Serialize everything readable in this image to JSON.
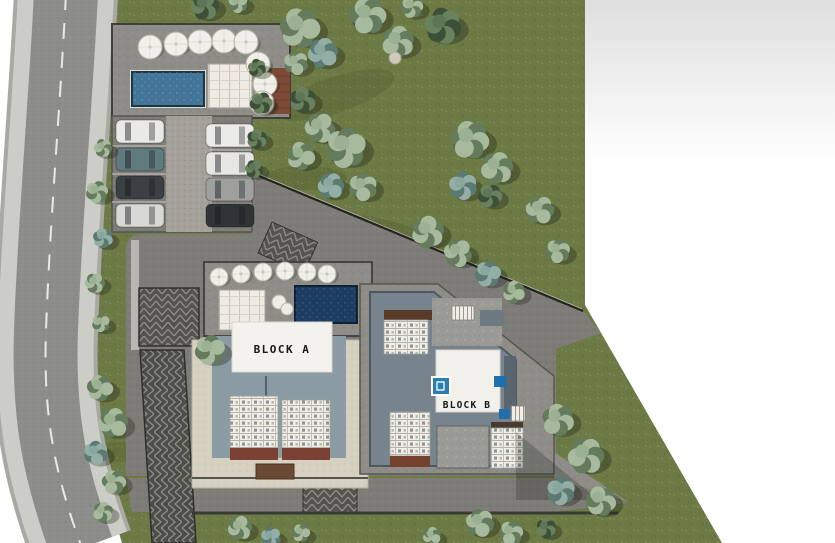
{
  "scene": {
    "type": "3d-architectural-site-plan-render",
    "labels": {
      "block_a": "BLOCK A",
      "block_b": "BLOCK B"
    },
    "palette": {
      "page": "#ffffff",
      "grass": "#6c7a45",
      "road_asphalt": "#8d8d89",
      "sidewalk": "#cdcdc8",
      "pavement": "#7e7c77",
      "walkway": "#8f8d87",
      "beige_court": "#d6d0c1",
      "terrace_pool": "#427598",
      "roof_pool": "#1d3c60",
      "roof_white": "#f4f2ec",
      "roof_bluegray": "#8b9ba4",
      "brick": "#7b4233",
      "wood_deck": "#7d4a36",
      "accent_blue": "#2b7fae",
      "fence": "#23231f"
    },
    "pool_terrace_umbrellas": [
      [
        150,
        47
      ],
      [
        176,
        44
      ],
      [
        200,
        42
      ],
      [
        224,
        41
      ],
      [
        246,
        42
      ],
      [
        258,
        64
      ],
      [
        265,
        84
      ],
      [
        262,
        103
      ]
    ],
    "block_a_deck_umbrellas": [
      [
        219,
        277
      ],
      [
        241,
        274
      ],
      [
        263,
        272
      ],
      [
        285,
        271
      ],
      [
        307,
        272
      ],
      [
        327,
        274
      ]
    ],
    "parking_cars_left": [
      {
        "x": 116,
        "y": 120,
        "color": "#e9e9e7"
      },
      {
        "x": 116,
        "y": 148,
        "color": "#5f7b7e"
      },
      {
        "x": 116,
        "y": 176,
        "color": "#3a4043"
      },
      {
        "x": 116,
        "y": 204,
        "color": "#d8d8d5"
      }
    ],
    "parking_cars_right": [
      {
        "x": 206,
        "y": 124,
        "color": "#ebebe9"
      },
      {
        "x": 206,
        "y": 152,
        "color": "#e6e6e3"
      },
      {
        "x": 206,
        "y": 178,
        "color": "#9fa09e"
      },
      {
        "x": 206,
        "y": 204,
        "color": "#303437"
      }
    ],
    "trees": [
      [
        205,
        6,
        14,
        "dark"
      ],
      [
        238,
        3,
        10,
        "sage"
      ],
      [
        300,
        28,
        20,
        "sage"
      ],
      [
        323,
        53,
        15,
        "teal"
      ],
      [
        296,
        63,
        12,
        "sage"
      ],
      [
        368,
        16,
        18,
        "sage"
      ],
      [
        398,
        42,
        16,
        "sage"
      ],
      [
        443,
        26,
        18,
        "dark"
      ],
      [
        412,
        7,
        11,
        "sage"
      ],
      [
        303,
        100,
        13,
        "dark"
      ],
      [
        320,
        128,
        15,
        "sage"
      ],
      [
        346,
        148,
        20,
        "sage"
      ],
      [
        301,
        156,
        14,
        "sage"
      ],
      [
        331,
        186,
        13,
        "teal"
      ],
      [
        363,
        187,
        14,
        "sage"
      ],
      [
        470,
        140,
        19,
        "sage"
      ],
      [
        497,
        168,
        16,
        "sage"
      ],
      [
        463,
        186,
        14,
        "teal"
      ],
      [
        490,
        196,
        12,
        "dark"
      ],
      [
        428,
        232,
        16,
        "sage"
      ],
      [
        458,
        253,
        14,
        "sage"
      ],
      [
        488,
        274,
        13,
        "teal"
      ],
      [
        514,
        292,
        11,
        "sage"
      ],
      [
        540,
        210,
        14,
        "sage"
      ],
      [
        558,
        251,
        12,
        "sage"
      ],
      [
        558,
        420,
        16,
        "sage"
      ],
      [
        586,
        456,
        18,
        "sage"
      ],
      [
        561,
        491,
        14,
        "teal"
      ],
      [
        601,
        501,
        15,
        "sage"
      ],
      [
        240,
        528,
        12,
        "sage"
      ],
      [
        271,
        537,
        10,
        "teal"
      ],
      [
        301,
        533,
        9,
        "sage"
      ],
      [
        432,
        536,
        9,
        "sage"
      ],
      [
        480,
        523,
        14,
        "sage"
      ],
      [
        511,
        533,
        12,
        "sage"
      ],
      [
        546,
        528,
        10,
        "dark"
      ],
      [
        103,
        148,
        9,
        "sage"
      ],
      [
        97,
        192,
        11,
        "sage"
      ],
      [
        103,
        238,
        10,
        "teal"
      ],
      [
        95,
        283,
        10,
        "sage"
      ],
      [
        101,
        323,
        9,
        "sage"
      ],
      [
        100,
        388,
        13,
        "sage"
      ],
      [
        113,
        423,
        15,
        "sage"
      ],
      [
        96,
        453,
        12,
        "teal"
      ],
      [
        114,
        482,
        12,
        "sage"
      ],
      [
        103,
        512,
        10,
        "sage"
      ],
      [
        257,
        68,
        9,
        "dark"
      ],
      [
        261,
        103,
        11,
        "dark"
      ],
      [
        257,
        139,
        10,
        "dark"
      ],
      [
        254,
        169,
        9,
        "dark"
      ],
      [
        210,
        350,
        15,
        "sage"
      ]
    ],
    "rocks": [
      [
        395,
        58,
        6
      ]
    ]
  }
}
